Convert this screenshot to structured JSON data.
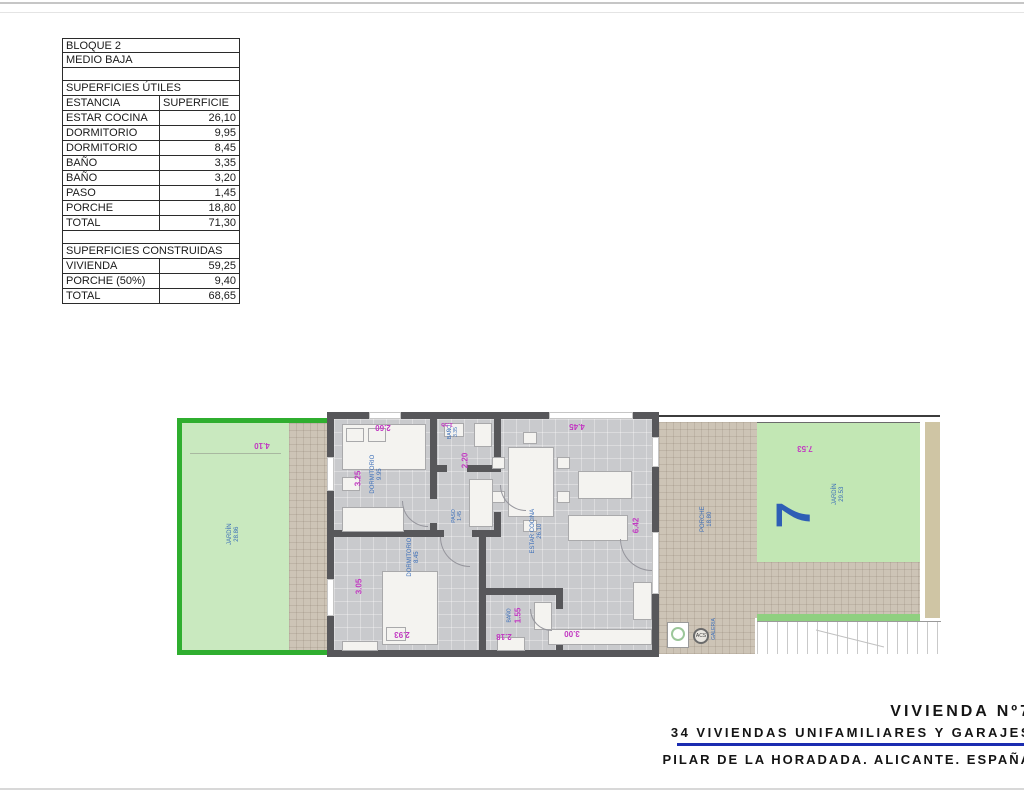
{
  "summary_table": {
    "block": "BLOQUE 2",
    "level": "MEDIO BAJA",
    "useful_title": "SUPERFICIES ÚTILES",
    "col_room": "ESTANCIA",
    "col_area": "SUPERFICIE",
    "useful_rows": [
      {
        "label": "ESTAR COCINA",
        "value": "26,10"
      },
      {
        "label": "DORMITORIO",
        "value": "9,95"
      },
      {
        "label": "DORMITORIO",
        "value": "8,45"
      },
      {
        "label": "BAÑO",
        "value": "3,35"
      },
      {
        "label": "BAÑO",
        "value": "3,20"
      },
      {
        "label": "PASO",
        "value": "1,45"
      },
      {
        "label": "PORCHE",
        "value": "18,80"
      },
      {
        "label": "TOTAL",
        "value": "71,30"
      }
    ],
    "built_title": "SUPERFICIES CONSTRUIDAS",
    "built_rows": [
      {
        "label": "VIVIENDA",
        "value": "59,25"
      },
      {
        "label": "PORCHE (50%)",
        "value": "9,40"
      },
      {
        "label": "TOTAL",
        "value": "68,65"
      }
    ]
  },
  "plan": {
    "unit_number": "7",
    "garden_left": {
      "label": "JARDÍN",
      "area": "28.86",
      "dim": "4.10"
    },
    "garden_right": {
      "label": "JARDÍN",
      "area": "29.53",
      "dim": "7.53"
    },
    "dorm1": {
      "label": "DORMITORIO",
      "area": "9.95",
      "dim_top": "2.60",
      "dim_side": "3.25"
    },
    "dorm2": {
      "label": "DORMITORIO",
      "area": "8.45",
      "dim_side": "3.05",
      "dim_bottom": "2.93"
    },
    "bano1": {
      "label": "BAÑO",
      "area": "3.35",
      "dim_top": "1.55",
      "dim_side": "2.20"
    },
    "bano2": {
      "label": "BAÑO",
      "dim_side": "1.55",
      "dim_bottom": "2.18"
    },
    "paso": {
      "label": "PASO",
      "area": "1.45"
    },
    "estar": {
      "label": "ESTAR COCINA",
      "area": "26.10",
      "dim_top": "4.45",
      "dim_side": "6.42",
      "dim_bottom": "3.00"
    },
    "porche": {
      "label": "PORCHE",
      "area": "18.80"
    },
    "galeria_label": "GALERIA",
    "acs_label": "ACS"
  },
  "title_block": {
    "line1": "VIVIENDA Nº7",
    "line2": "34 VIVIENDAS UNIFAMILIARES Y GARAJES",
    "line3": "PILAR DE LA HORADADA. ALICANTE. ESPAÑA"
  },
  "colors": {
    "garden_border": "#2fae2f",
    "garden_fill_left": "#c9e9bf",
    "garden_fill_right": "#c2e7b4",
    "wall": "#57575a",
    "floor": "#c9cacd",
    "hatch": "#cdc4b6",
    "dim_text": "#c238c2",
    "room_label_blue": "#3a6db8",
    "unit_number_blue": "#2e5eb5",
    "rule_blue": "#1b2cb0"
  }
}
